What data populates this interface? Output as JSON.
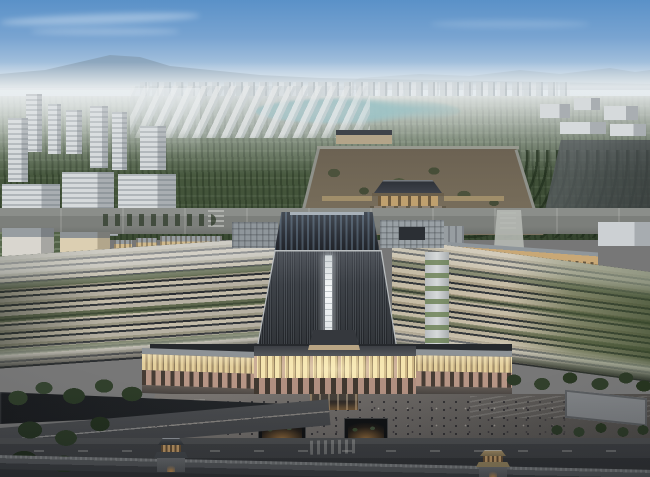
{
  "meta": {
    "type": "architectural-aerial-rendering",
    "subject": "Dusk bird's-eye rendering of a large railway station with a dark ribbed arch roof and white spine skylight, flanked by striped platform canopies, facing a walled palace heritage park with a traditional gate hall, surrounded by a modern city district, dense green parkland, a lake, plazas with crowds, roads and corner gate towers on a heritage wall",
    "visible_text": "none"
  },
  "palette": {
    "sky_top": "#5a91c8",
    "sky_mid": "#a9c4de",
    "sky_horizon": "#e3e9ec",
    "mountain": "#7e93a6",
    "mountain_far": "#8ea2b2",
    "distant_city": "#c9cfd3",
    "park_light": "#66755a",
    "park_dark": "#3a4a32",
    "lake": "#9cc3c6",
    "city_building": "#d6dadc",
    "city_shadow": "#a9aeb2",
    "compound_ground": "#6b6152",
    "compound_wall": "#97998f",
    "palace_roof": "#2c3036",
    "palace_wall": "#bfa06e",
    "roof_dark": "#222529",
    "roof_frame": "#b9bdbf",
    "spine_white": "#f5f8f9",
    "canopy_beige": "#c3bba8",
    "canopy_gap": "#2c2f33",
    "track_green": "#4e5c40",
    "ancillary_cream": "#dccfb2",
    "ancillary_roof": "#979da1",
    "gold_facade": "#c9a876",
    "glass_warm": "#f4e4ae",
    "stone_pink": "#b69585",
    "plaza_gray": "#6e6a67",
    "road_dark": "#404245",
    "wall_gray": "#595c5f",
    "tree_dark": "#2a3926",
    "warm_glow": "#d69a52"
  },
  "scene": {
    "elements": [
      {
        "name": "sky",
        "desc": "blue-to-haze dusk gradient with thin cloud streaks"
      },
      {
        "name": "mountain-range",
        "desc": "hazy ridges on the horizon, taller at left"
      },
      {
        "name": "distant-city",
        "desc": "pale low-rise blocks along the horizon"
      },
      {
        "name": "greenbelt-park",
        "desc": "dense tree rows filling the middle distance"
      },
      {
        "name": "lake",
        "desc": "pale teal water body in the park"
      },
      {
        "name": "left-city-district",
        "desc": "cluster of white towers and slabs"
      },
      {
        "name": "right-city-district",
        "desc": "smaller distant blocks at right"
      },
      {
        "name": "palace-compound",
        "desc": "walled earthen archaeological field with scattered trees"
      },
      {
        "name": "palace-gate-hall",
        "desc": "traditional hip-roofed gate hall on a platform"
      },
      {
        "name": "north-station-hall",
        "desc": "dark glazed traditional-style roof"
      },
      {
        "name": "main-station-roof",
        "desc": "trapezoidal dark ribbed roof with glowing white central spine"
      },
      {
        "name": "platform-canopies",
        "desc": "long striped canopies and green track beds on both sides"
      },
      {
        "name": "south-facade",
        "desc": "warm-lit glass band over a stone colonnade arcade"
      },
      {
        "name": "south-plaza",
        "desc": "broad grey plaza dotted with crowds and two sunken lit courts"
      },
      {
        "name": "roads",
        "desc": "dark asphalt roads and a sunken ramp at lower left"
      },
      {
        "name": "heritage-wall",
        "desc": "long grey wall across the bottom edge"
      },
      {
        "name": "gate-towers",
        "desc": "two small traditional gate towers with warm-lit bases"
      }
    ]
  }
}
